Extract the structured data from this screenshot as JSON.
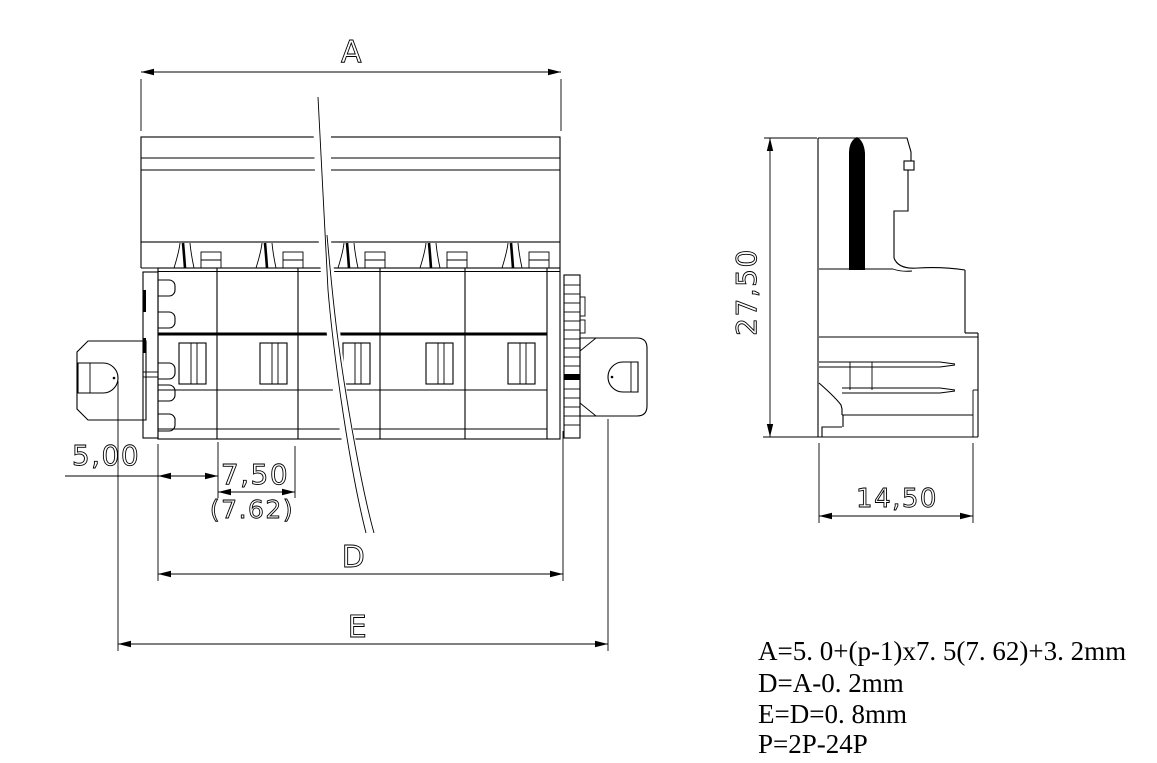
{
  "dimensions": {
    "overall": "A",
    "offset": "5,00",
    "pitch": "7,50",
    "pitch_alt": "(7.62)",
    "inner": "D",
    "outer": "E",
    "height": "27,50",
    "depth": "14,50"
  },
  "formulas": [
    "A=5. 0+(p-1)x7. 5(7. 62)+3. 2mm",
    "D=A-0. 2mm",
    "E=D=0. 8mm",
    "P=2P-24P"
  ],
  "colors": {
    "line": "#000000",
    "background": "#ffffff"
  }
}
